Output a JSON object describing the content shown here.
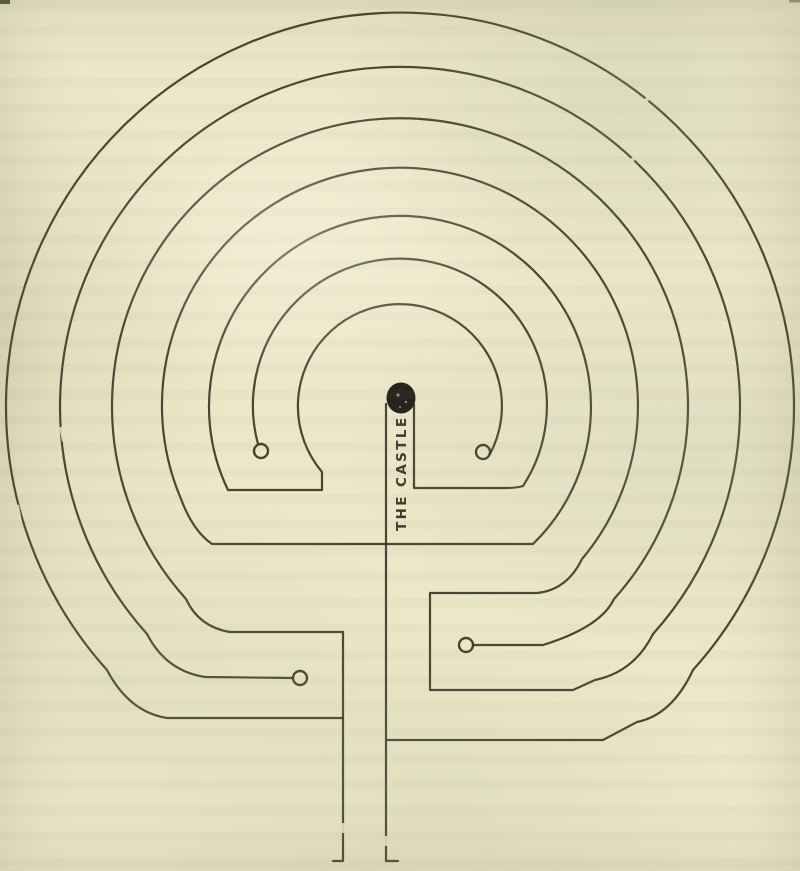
{
  "figure": {
    "center_label": "THE CASTLE",
    "ring_count": 7,
    "dead_end_count": 4
  },
  "colors": {
    "paper": "#ebe7c9",
    "ink": "#3b3828",
    "dot": "#23211a"
  }
}
